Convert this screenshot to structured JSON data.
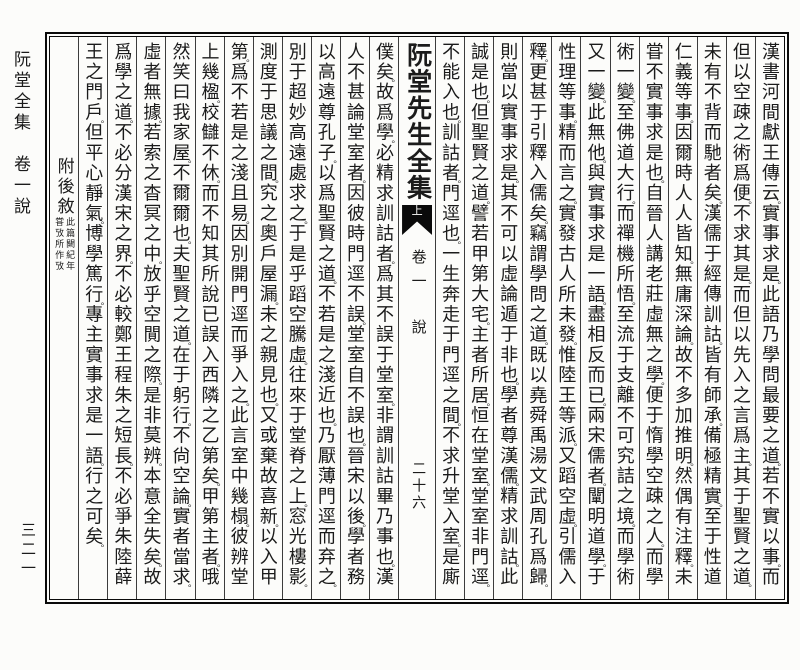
{
  "colors": {
    "ink": "#1b1b1b",
    "paper": "#fcfcfa",
    "rule": "#3c3c3c",
    "frame": "#0a0a0a"
  },
  "page": {
    "margin_left": {
      "booklet_title": "阮堂全集　卷一說",
      "page_number_outer": "三二一"
    },
    "center_column": {
      "title": "阮堂先生全集",
      "fishtail_label": "上",
      "volume": "卷一",
      "section": "說",
      "page_number": "二十六"
    },
    "appendix_column": {
      "heading": "附後敘",
      "note_right": "此篇闕紀年",
      "note_left": "甞攷所作攷"
    },
    "columns_right": [
      "漢書河間獻王傳云。實事求是。此語乃學問最要之道。若不實以事。而",
      "但以空疎之術爲便。不求其是。而但以先入之言爲主。其于聖賢之道。",
      "未有不背而馳者矣。漢儒于經傳訓詁。皆有師承。備極精實。至于性道",
      "仁義等事。因爾時人人皆知。無庸深論。故不多加推明。然偶有注釋。未",
      "甞不實事求是也。自晉人講老莊虛無之學。便于惰學空疎之人。而學",
      "術一變。至佛道大行。而禪機所悟。至流于支離不可究詰之境。而學術",
      "又一變。此無他。與實事求是一語。盡相反而已。兩宋儒者。闡明道學。于",
      "性理等事。精而言之。實發古人所未發。惟陸王等派。又蹈空虛。引儒入",
      "釋。更甚于引釋入儒矣。竊謂學問之道。既以堯舜禹湯文武周孔爲歸。",
      "則當以實事求是。其不可以虛論遁于非也。學者尊漢儒。精求訓詁。此",
      "誠是也。但聖賢之道。譬若甲第大宅。主者所居。恒在堂室。堂室非門逕。",
      "不能入也。訓詁者。門逕也。一生奔走于門逕之間。不求升堂入室。是廝"
    ],
    "columns_left": [
      "僕矣。故爲學。必精求訓詁者。爲其不誤于堂室。非謂訓詁畢乃事也。漢",
      "人不甚論堂室者。因彼時門逕不誤。堂室自不誤也。晉宋以後。學者務",
      "以高遠尊孔子。以爲聖賢之道。不若是之淺近也。乃厭薄門逕而弃之。",
      "別于超妙高遠處求之。于是乎蹈空騰虛。往來于堂脊之上。窓光樓影。",
      "測度于思議之間。究之奧戶屋漏。未之親見也。又或棄故喜新。以入甲",
      "第。爲不若是之淺且易。因別開門逕而爭入之。此言室中幾榻。彼辨堂",
      "上幾楹。校讎不休。而不知其所說已誤入西隣之乙第矣。甲第主者。哦",
      "然笑曰我家屋。不爾爾也。夫聖賢之道。在于躬行。不尙空論。實者當求。",
      "虛者無據。若索之杳冥之中。放乎空閴之際。是非莫辨。本意全失矣。故",
      "爲學之道。不必分漢宋之界。不必較鄭王程朱之短長。不必爭朱陸薛",
      "王之門戶。但平心靜氣。博學篤行。專主實事求是一語。行之可矣。"
    ]
  }
}
